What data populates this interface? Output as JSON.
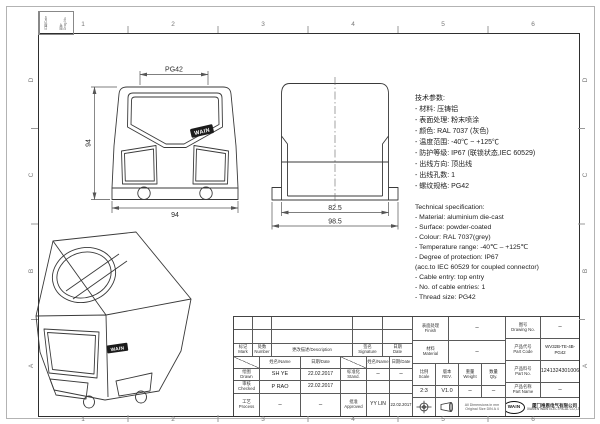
{
  "sheet": {
    "grid_top": [
      "1",
      "2",
      "3",
      "4",
      "5",
      "6"
    ],
    "grid_bottom": [
      "1",
      "2",
      "3",
      "4",
      "5",
      "6"
    ],
    "grid_left": [
      "D",
      "C",
      "B",
      "A"
    ],
    "grid_right": [
      "D",
      "C",
      "B",
      "A"
    ],
    "corner_cell_1": "日期/Date",
    "corner_cell_2": "图号\nDrwg.No."
  },
  "views": {
    "front": {
      "logo": "WAIN",
      "dim_thread": "PG42",
      "dim_height": "94",
      "dim_width": "94"
    },
    "side": {
      "dim_body": "82.5",
      "dim_flange": "98.5"
    },
    "iso": {
      "logo": "WAIN"
    }
  },
  "specs_cn": {
    "lines": [
      "技术参数:",
      "- 材料: 压铸铝",
      "- 表面处理: 粉末喷涂",
      "- 颜色: RAL 7037 (灰色)",
      "- 温度范围: -40℃ ~ +125℃",
      "- 防护等级: IP67 (联锁状态,IEC 60529)",
      "- 出线方向: 顶出线",
      "- 出线孔数: 1",
      "- 螺纹规格: PG42"
    ]
  },
  "specs_en": {
    "lines": [
      "Technical specification:",
      "- Material: aluminium die-cast",
      "- Surface: powder-coated",
      "- Colour: RAL 7037(grey)",
      "- Temperature range: -40℃ – +125℃",
      "- Degree of protection: IP67",
      "  (acc.to IEC 60529 for coupled connector)",
      "- Cable entry: top entry",
      "- No. of cable entries: 1",
      "- Thread size: PG42"
    ]
  },
  "title_block": {
    "rev": {
      "mark": "标记\nMark",
      "number": "处数\nNumber",
      "description": "更改描述/Description",
      "signature": "签名\nSignature",
      "date": "日期\nDate"
    },
    "sig": {
      "name_header": "姓名/Name",
      "date_header": "日期/Date",
      "drawn_label": "绘图\nDrawn",
      "drawn_name": "SH YE",
      "drawn_date": "22.02.2017",
      "checked_label": "审核\nChecked",
      "checked_name": "P RAO",
      "checked_date": "22.02.2017",
      "process_label": "工艺\nProcess",
      "process_name": "–",
      "process_date": "–",
      "stand_label": "标准化\nStand.",
      "stand_name": "–",
      "stand_date": "–",
      "approved_label": "批准\nApproved",
      "approved_name": "YY LIN",
      "approved_date": "22.02.2017"
    },
    "finish_label": "表面处理\nFinish",
    "finish_value": "–",
    "material_label": "材料\nMaterial",
    "material_value": "–",
    "scale_label": "比例\nScale",
    "scale_value": "2:3",
    "rev_label": "版本\nREV.",
    "rev_value": "V1.0",
    "weight_label": "重量\nWeight",
    "weight_value": "–",
    "qty_label": "数量\nQty.",
    "qty_value": "–",
    "note_line1": "All Dimensions in mm",
    "note_line2": "Original Size DIN A 4",
    "drawing_no_label": "图号\nDrawing No.",
    "drawing_no_value": "–",
    "part_code_label": "产品代号\nPart Code",
    "part_code_value": "WV32B-TE-4B-PG42",
    "part_no_label": "产品料号\nPart No.",
    "part_no_value": "1241324301006",
    "part_name_label": "产品名称\nPart Name",
    "part_name_value": "–",
    "company_logo": "WAIN",
    "company_cn": "厦门唯恩电气有限公司",
    "company_en": "XIAMEN WAIN ELECTRICAL CO.,LTD"
  }
}
